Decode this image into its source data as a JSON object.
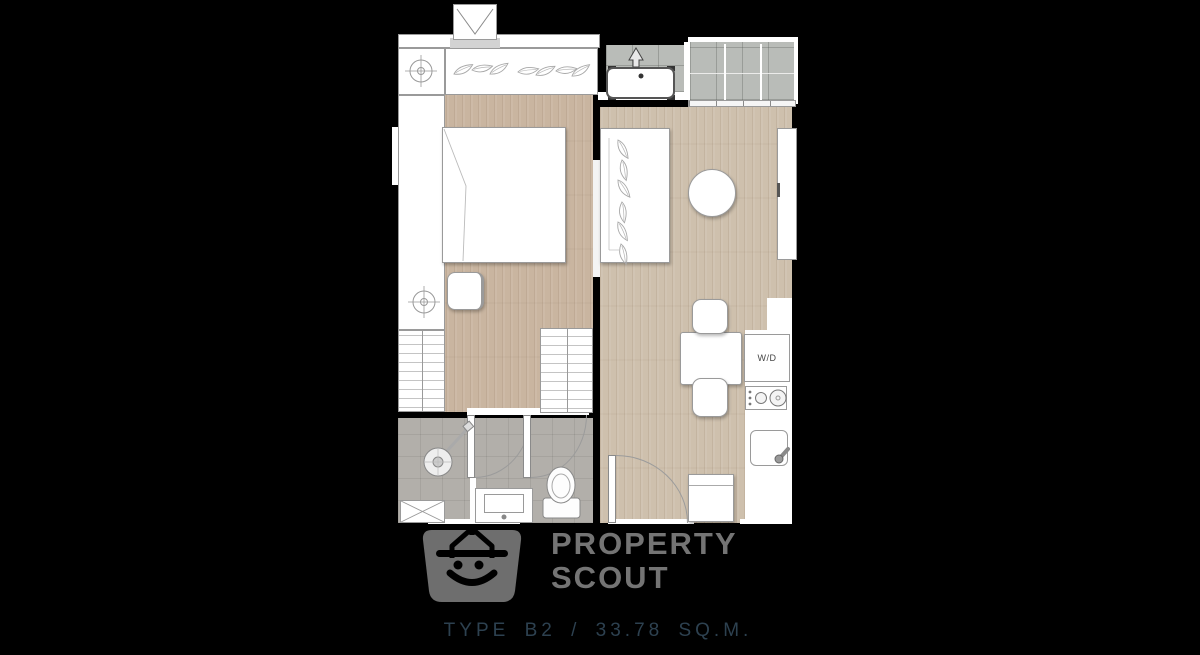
{
  "floorplan": {
    "caption": "TYPE B2 / 33.78 SQ.M.",
    "unit_type": "TYPE B2",
    "area": "33.78 SQ.M.",
    "labels": {
      "washer_dryer": "W/D"
    },
    "rooms": [
      "bedroom",
      "living-dining",
      "kitchen",
      "bathroom",
      "balcony",
      "ac-ledge"
    ],
    "furniture": [
      "wardrobe",
      "bed",
      "desk-chair",
      "drawer-units",
      "closet",
      "sofa-console",
      "round-table",
      "tv-console",
      "dining-table",
      "chairs",
      "washer-dryer",
      "stove",
      "kitchen-sink",
      "fridge",
      "shower",
      "vanity-sink",
      "toilet",
      "ac-condenser-unit"
    ],
    "colors": {
      "background": "#000000",
      "wood_floor": "#cec0ad",
      "bedroom_floor": "#c9b5a0",
      "balcony_tile": "#b9bcb8",
      "bathroom_tile": "#b2afaa",
      "furniture_outline": "#9a9a9a",
      "caption_text": "#2d4150",
      "watermark_gray": "#6f6f6f"
    }
  },
  "watermark": {
    "line1": "PROPERTY",
    "line2": "SCOUT"
  }
}
